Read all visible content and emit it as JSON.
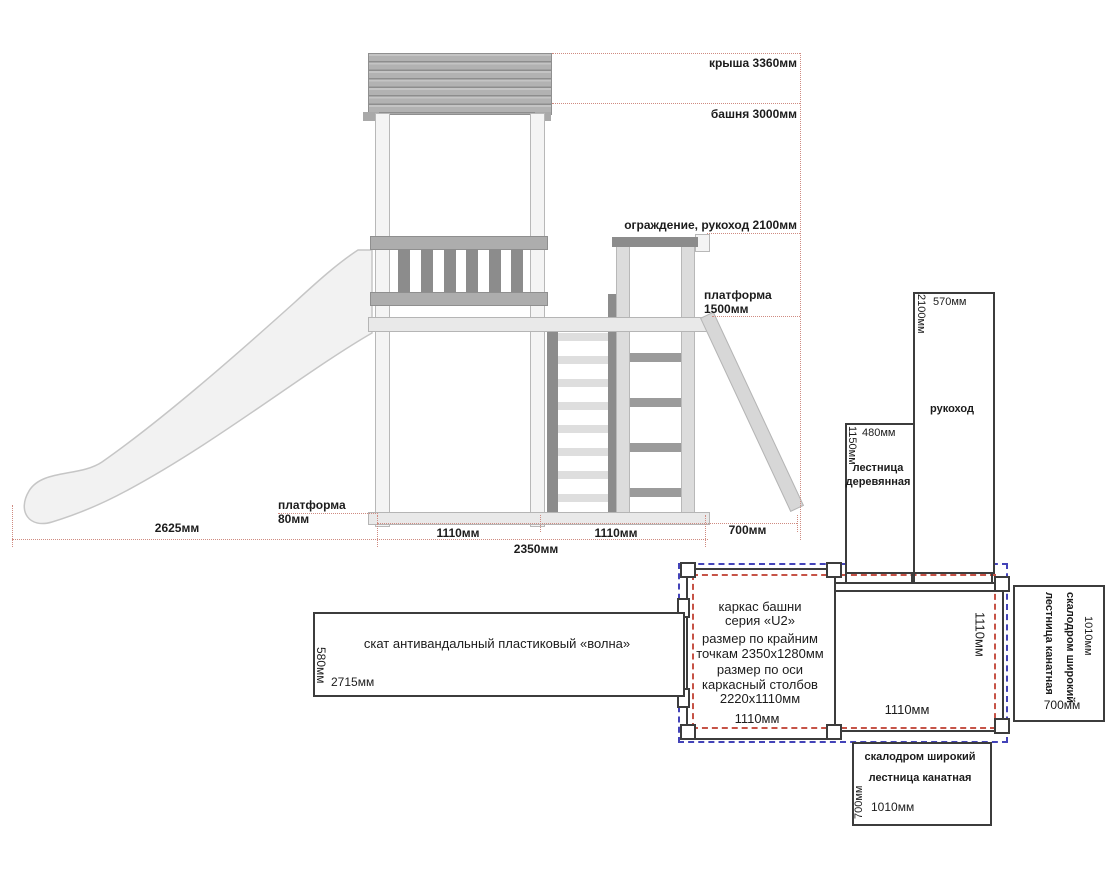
{
  "colors": {
    "dim_line_red": "#cf8b81",
    "dash_blue": "#4343b8",
    "dash_red": "#c65347",
    "text_blue": "#2b35b5",
    "text_red": "#cc2a20"
  },
  "elevation": {
    "labels": {
      "roof": "крыша 3360мм",
      "tower": "башня 3000мм",
      "railing": "ограждение, рукоход 2100мм",
      "platform": "платформа 1500мм",
      "platform_plank": "платформа 80мм"
    },
    "dims": {
      "slide_run": "2625мм",
      "bay_left": "1110мм",
      "bay_right": "1110мм",
      "brace": "700мм",
      "frame": "2350мм"
    }
  },
  "side_boxes": {
    "wooden_ladder": {
      "title": "лестница деревянная",
      "width": "480мм",
      "height": "1150мм"
    },
    "monkey_bars": {
      "title": "рукоход",
      "width": "570мм",
      "height": "2100мм"
    },
    "slide": {
      "title": "скат антивандальный пластиковый «волна»",
      "height": "580мм",
      "length": "2715мм"
    },
    "climb_right": {
      "line1": "скалодром широкий",
      "line2": "лестница канатная",
      "length": "1010мм",
      "width": "700мм"
    },
    "climb_bottom": {
      "line1": "скалодром широкий",
      "line2": "лестница канатная",
      "width": "700мм",
      "length": "1010мм"
    }
  },
  "plan": {
    "title_line1": "каркас башни",
    "title_line2": "серия «U2»",
    "outer_size": "размер по крайним точкам 2350х1280мм",
    "axis_size": "размер по оси каркасный столбов 2220х1110мм",
    "dim_left_bay": "1110мм",
    "dim_right_bay": "1110мм",
    "dim_depth": "1110мм"
  }
}
